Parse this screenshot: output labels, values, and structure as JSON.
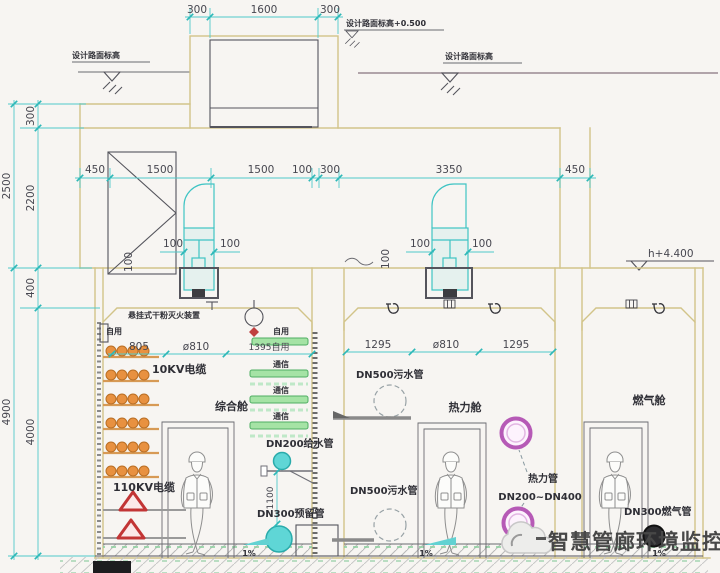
{
  "drawing": {
    "type": "utility-tunnel-cross-section",
    "watermark": "智慧管廊环境监控"
  },
  "elevations": {
    "road_left": "设计路面标高",
    "shaft_top": "设计路面标高+0.500",
    "road_right": "设计路面标高",
    "roof_right": "h+4.400"
  },
  "dims": {
    "shaft": {
      "left": "300",
      "mid": "1600",
      "right": "300"
    },
    "top": {
      "d1": "450",
      "d2": "1500",
      "d3": "1500",
      "d4": "100",
      "d5": "300",
      "d6": "3350",
      "d7": "450"
    },
    "left_outer": {
      "upper": "2500",
      "lower": "4900"
    },
    "left_inner": {
      "d1": "300",
      "d2": "2200",
      "d3": "400",
      "d4": "4000"
    },
    "cabin1": {
      "d1": "805",
      "d2": "ø810",
      "d3": "1395自用"
    },
    "cabin2": {
      "d1": "1295",
      "d2": "ø810",
      "d3": "1295"
    },
    "fan_left": {
      "l": "100",
      "r": "100"
    },
    "fan_right": {
      "l": "100",
      "r": "100"
    },
    "louvre": "100",
    "ceiling": "100",
    "riser": "1100"
  },
  "cabin1": {
    "name": "综合舱",
    "self_use_top": "自用",
    "self_use_right": "自用",
    "fire_device": "悬挂式干粉灭火装置",
    "cable_10kv": "10KV电缆",
    "cable_110kv": "110KV电缆",
    "comm1": "通信",
    "comm2": "通信",
    "comm3": "通信",
    "water_pipe": "DN200给水管",
    "reserved_pipe": "DN300预留管",
    "slope": "1%"
  },
  "cabin2": {
    "name": "热力舱",
    "sewage_upper": "DN500污水管",
    "sewage_lower": "DN500污水管",
    "heat_line1": "热力管",
    "heat_line2": "DN200~DN400",
    "slope": "1%"
  },
  "cabin3": {
    "name": "燃气舱",
    "gas_pipe": "DN300燃气管",
    "slope": "1%"
  },
  "colors": {
    "wall": "#d2c489",
    "dimension": "#3fc4c4",
    "cable_orange": "#e89140",
    "cable_110kv_red": "#c23535",
    "comm_green": "#6fc97f",
    "water_cyan": "#5fd6d6",
    "heat_pink": "#b65ab6",
    "ground_line": "#9a8a92",
    "watermark_gray": "#474747"
  }
}
